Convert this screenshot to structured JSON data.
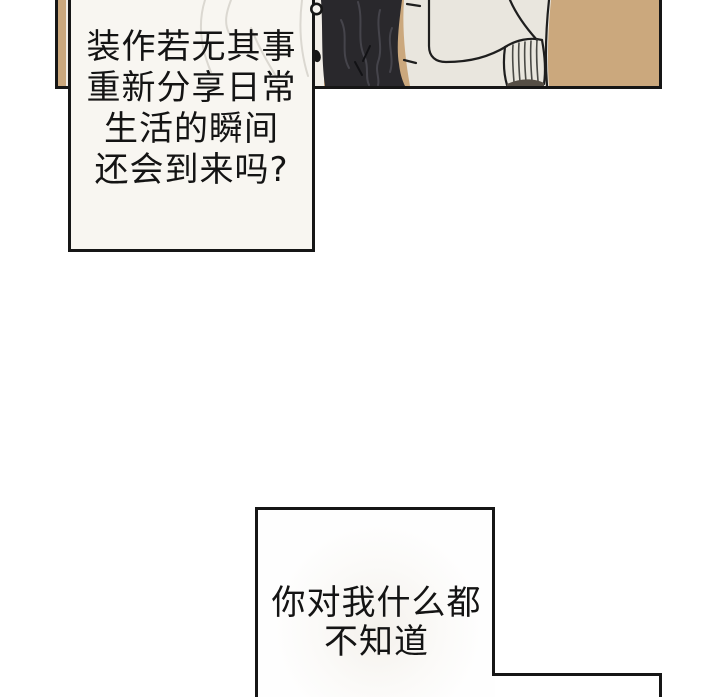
{
  "bubbles": {
    "top": {
      "fill": "#f8f6f1",
      "lines": [
        "装作若无其事",
        "重新分享日常",
        "生活的瞬间",
        "还会到来吗?"
      ]
    },
    "bottom": {
      "fill": "#fefefe",
      "lines": [
        "你对我什么都",
        "不知道"
      ]
    }
  },
  "panel": {
    "background_color": "#cba87d",
    "coat_color": "#29282c",
    "sweater_color": "#e9e6de",
    "shirt_color": "#f2efe9",
    "outline_color": "#161616"
  }
}
